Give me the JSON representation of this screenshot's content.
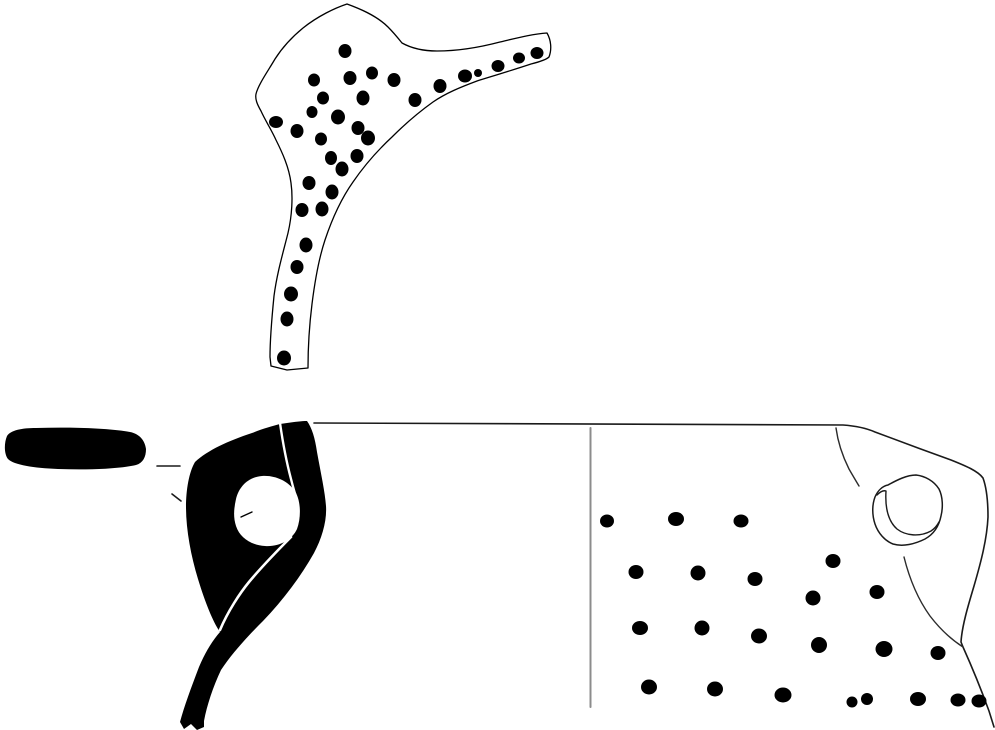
{
  "figure": {
    "canvas": {
      "width": 995,
      "height": 730,
      "background": "#ffffff",
      "ink": "#000000",
      "divider_color": "#8c8c8c"
    },
    "layers": [
      {
        "name": "top-sherd-outline",
        "type": "path",
        "d": "M347,4 C335,8 318,16 303,28 C292,37 282,48 275,59 C268,71 258,85 256,94 C255,99 257,104 261,111 C265,120 271,129 276,140 C282,152 289,167 291,183 C293,197 292,216 288,233 C283,253 277,273 274,296 C272,316 270,339 270,357 L271,366 L287,370 L308,368 C308,351 309,328 312,304 C315,280 319,258 325,240 C332,219 341,199 353,182 C364,166 378,150 392,137 C405,124 419,112 433,102 C446,93 461,87 477,81 C493,76 513,70 531,64 C539,62 546,60 549,57 C552,49 551,40 547,33 C532,34 517,38 500,42 C481,47 458,51 437,51 C423,51 411,48 402,43 C398,38 393,32 388,27 C376,15 358,8 347,4 Z",
        "fill": "#ffffff",
        "stroke": "#000000",
        "stroke_width": 1.3
      },
      {
        "name": "top-sherd-dots",
        "type": "dots",
        "fill": "#000000",
        "dots": [
          [
            345,
            51,
            6.5,
            7
          ],
          [
            314,
            80,
            6,
            6.5
          ],
          [
            350,
            78,
            6.5,
            7
          ],
          [
            372,
            73,
            6,
            6.5
          ],
          [
            394,
            80,
            6.5,
            7
          ],
          [
            323,
            98,
            6,
            6.5
          ],
          [
            363,
            98,
            6.5,
            7.5
          ],
          [
            415,
            100,
            6.5,
            7
          ],
          [
            312,
            112,
            5.5,
            6
          ],
          [
            338,
            117,
            7,
            7.5
          ],
          [
            276,
            122,
            7,
            6
          ],
          [
            297,
            131,
            6.5,
            7
          ],
          [
            358,
            128,
            6.5,
            7
          ],
          [
            321,
            139,
            6,
            6.5
          ],
          [
            368,
            138,
            7,
            7.5
          ],
          [
            331,
            158,
            6,
            7
          ],
          [
            357,
            156,
            6.5,
            7
          ],
          [
            342,
            169,
            6.5,
            7.5
          ],
          [
            309,
            183,
            6.5,
            7
          ],
          [
            332,
            192,
            6.5,
            7.5
          ],
          [
            302,
            210,
            6.5,
            7
          ],
          [
            322,
            209,
            6.5,
            7.5
          ],
          [
            306,
            245,
            6.5,
            7.5
          ],
          [
            297,
            267,
            6.5,
            7
          ],
          [
            291,
            294,
            7,
            7.5
          ],
          [
            287,
            319,
            6.5,
            7.5
          ],
          [
            284,
            358,
            7,
            7.5
          ],
          [
            440,
            86,
            6.5,
            7
          ],
          [
            465,
            76,
            7,
            6.5
          ],
          [
            478,
            73,
            4,
            4
          ],
          [
            498,
            66,
            6.5,
            6
          ],
          [
            519,
            58,
            6,
            5.5
          ],
          [
            537,
            53,
            6.5,
            6
          ]
        ]
      },
      {
        "name": "profile-rim-section",
        "type": "path",
        "d": "M7,436 C11,430 22,428 36,428 C70,427 108,428 130,432 C140,434 145,441 146,449 C146,457 143,463 136,465 C118,469 88,470 58,469 C34,468 14,465 8,459 C4,454 4,443 7,436 Z",
        "fill": "#000000",
        "stroke": "none"
      },
      {
        "name": "leader-tick-horizontal",
        "type": "path",
        "d": "M157,466 L180,466",
        "fill": "none",
        "stroke": "#1a1a1a",
        "stroke_width": 1.6
      },
      {
        "name": "leader-tick-diagonal",
        "type": "path",
        "d": "M172,494 L181,501",
        "fill": "none",
        "stroke": "#1a1a1a",
        "stroke_width": 1.6
      },
      {
        "name": "profile-handle-silhouette",
        "type": "path",
        "d": "M195,462 C208,450 228,441 252,433 C262,429 272,426 280,424 L287,423 C294,422 302,421 307,421 C312,428 315,438 317,452 C321,474 325,492 326,506 C327,521 322,538 314,553 C301,576 284,599 263,621 C248,636 233,652 221,670 C213,687 207,705 204,721 L204,727 L197,730 L191,724 L184,729 L180,722 C184,707 191,688 199,667 C205,653 212,641 220,632 C213,622 205,602 198,579 C191,556 186,530 186,507 C186,490 189,472 195,462 Z",
        "fill": "#000000",
        "stroke": "none"
      },
      {
        "name": "profile-handle-hole",
        "type": "path",
        "d": "M236,499 C239,486 249,477 262,476 C276,475 290,482 296,493 C301,503 301,518 297,529 C292,540 279,547 265,546 C251,545 240,538 236,526 C233,517 234,508 236,499 Z",
        "fill": "#ffffff",
        "stroke": "none"
      },
      {
        "name": "profile-hole-tick",
        "type": "path",
        "d": "M241,517 L252,512",
        "fill": "none",
        "stroke": "#000000",
        "stroke_width": 1.4
      },
      {
        "name": "profile-white-contour-upper",
        "type": "path",
        "d": "M280,423 C283,444 287,464 291,479 C293,487 295,494 297,500",
        "fill": "none",
        "stroke": "#ffffff",
        "stroke_width": 2.4
      },
      {
        "name": "profile-white-contour-lower",
        "type": "path",
        "d": "M291,537 C280,548 264,564 249,582 C240,593 228,611 220,630",
        "fill": "none",
        "stroke": "#ffffff",
        "stroke_width": 2.6
      },
      {
        "name": "body-sherd-outline",
        "type": "path",
        "d": "M314,423 L843,425 C857,426 866,428 875,432 C899,441 926,451 951,460 C966,466 978,471 983,478 C987,489 988,504 988,517 C987,539 981,562 974,586 C968,606 962,626 961,642 L963,647 C972,667 981,689 989,711 L994,727",
        "fill": "none",
        "stroke": "#1a1a1a",
        "stroke_width": 1.6
      },
      {
        "name": "section-divider-line",
        "type": "line",
        "x1": 590.5,
        "y1": 428,
        "x2": 590.5,
        "y2": 707,
        "fill": "none",
        "stroke": "#8c8c8c",
        "stroke_width": 2
      },
      {
        "name": "body-contour-line",
        "type": "path",
        "d": "M904,557 C909,577 917,598 930,616 C940,629 952,640 963,647",
        "fill": "none",
        "stroke": "#2b2b2b",
        "stroke_width": 1.4
      },
      {
        "name": "body-crack-line",
        "type": "path",
        "d": "M836,428 C838,443 843,457 849,469 C853,476 856,481 859,486",
        "fill": "none",
        "stroke": "#2b2b2b",
        "stroke_width": 1.4
      },
      {
        "name": "handle-stump-outer-outline",
        "type": "path",
        "d": "M916,475 C925,476 934,481 939,489 C943,497 943,508 941,516 C939,526 934,534 925,539 C915,544 903,547 893,544 C885,541 878,533 875,524 C872,515 872,505 875,497 C878,490 883,486 888,485 C897,480 907,475 916,475 Z",
        "fill": "#ffffff",
        "stroke": "#1a1a1a",
        "stroke_width": 1.5
      },
      {
        "name": "handle-stump-inner-line",
        "type": "path",
        "d": "M877,495 C880,492 883,490 886,491 C885,507 888,521 897,529 C906,536 920,537 931,531 C934,529 937,526 939,522",
        "fill": "none",
        "stroke": "#1a1a1a",
        "stroke_width": 1.4
      },
      {
        "name": "body-sherd-dots",
        "type": "dots",
        "fill": "#000000",
        "dots": [
          [
            607,
            521,
            7,
            6.5
          ],
          [
            676,
            519,
            8,
            7
          ],
          [
            741,
            521,
            7.5,
            6.5
          ],
          [
            636,
            572,
            7.5,
            7
          ],
          [
            698,
            573,
            7.5,
            7.5
          ],
          [
            755,
            579,
            7.5,
            7
          ],
          [
            833,
            561,
            7.5,
            7
          ],
          [
            877,
            592,
            7.5,
            7
          ],
          [
            813,
            598,
            7.5,
            7.5
          ],
          [
            640,
            628,
            8,
            7
          ],
          [
            702,
            628,
            7.5,
            7.5
          ],
          [
            759,
            636,
            8,
            7.5
          ],
          [
            819,
            645,
            8,
            8
          ],
          [
            884,
            649,
            8.5,
            8
          ],
          [
            938,
            653,
            7.5,
            7
          ],
          [
            649,
            687,
            8,
            7.5
          ],
          [
            715,
            689,
            8,
            7.5
          ],
          [
            783,
            695,
            8.5,
            7.5
          ],
          [
            852,
            702,
            5.5,
            5.5
          ],
          [
            867,
            699,
            6,
            6
          ],
          [
            918,
            699,
            8,
            7
          ],
          [
            958,
            700,
            7.5,
            6.5
          ],
          [
            979,
            701,
            7.5,
            6.5
          ]
        ]
      }
    ]
  }
}
